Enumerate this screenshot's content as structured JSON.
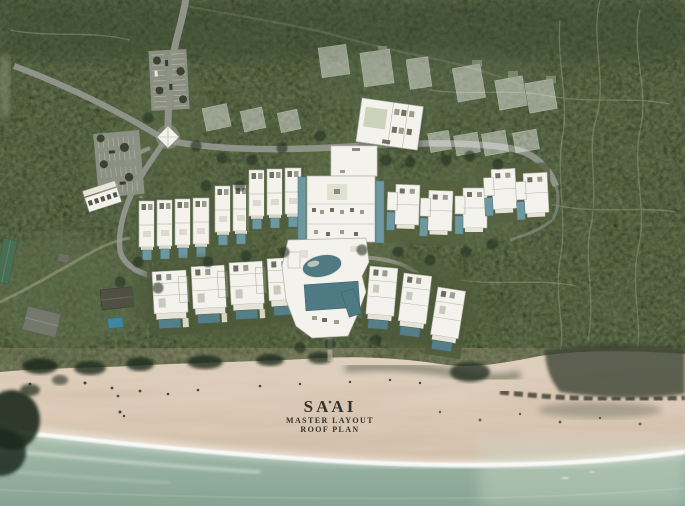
{
  "title": {
    "project": "SAAI",
    "subtitle_line1": "MASTER LAYOUT",
    "subtitle_line2": "ROOF PLAN"
  },
  "map": {
    "type": "aerial-photo-master-plan",
    "terrain": [
      "forest",
      "lawn-clearings",
      "beach",
      "ocean"
    ],
    "features": {
      "entrance_road_from_top": 1,
      "parking_lots": 2,
      "arrival_pavilion": 1,
      "spa_building": 1,
      "main_building_with_flanking_pools": 1,
      "lagoon_pool": 1,
      "main_rect_pool": 1,
      "garden_villas": 9,
      "hillside_villas": 5,
      "beachfront_villas": 4,
      "east_beach_villas": 3,
      "future_phase_pads": 13,
      "existing_neighbour_buildings": 4
    },
    "colors": {
      "forest_base": "#41503a",
      "canopy_dark": "#26321f",
      "clearing_green": "#61704b",
      "road_gray": "#90938a",
      "roof_white": "#f3f2ec",
      "phantom_roof_opacity": "0.42",
      "pool_teal": "#5e8a91",
      "sand": "#ddcbb8",
      "ocean": "#93b0a0",
      "foam": "#ffffff",
      "title_text": "#33322c"
    }
  }
}
